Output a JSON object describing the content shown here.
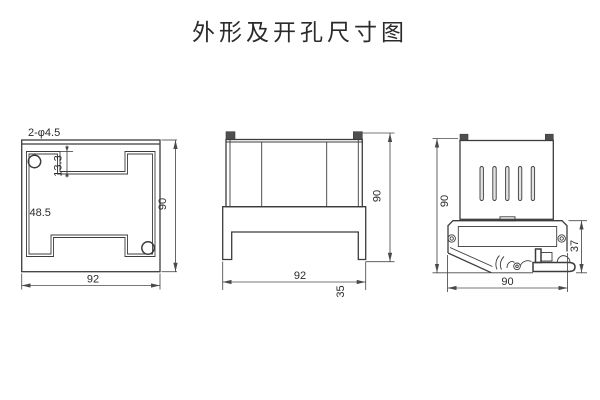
{
  "title": "外形及开孔尺寸图",
  "cutout_view": {
    "holes_label": "2-φ4.5",
    "notch_depth": "13.3",
    "section_height": "48.5",
    "width": "92",
    "height": "90"
  },
  "side_view": {
    "width": "92",
    "height": "90",
    "depth": "35"
  },
  "rear_view": {
    "height": "90",
    "bracket_height": "37",
    "width": "90"
  },
  "colors": {
    "line": "#3c3c3c",
    "dim": "#4a4a4a",
    "text": "#2b2b2b",
    "tab_fill": "#4f4f4f",
    "slot_fill": "#e2e2e2",
    "background": "#ffffff"
  }
}
